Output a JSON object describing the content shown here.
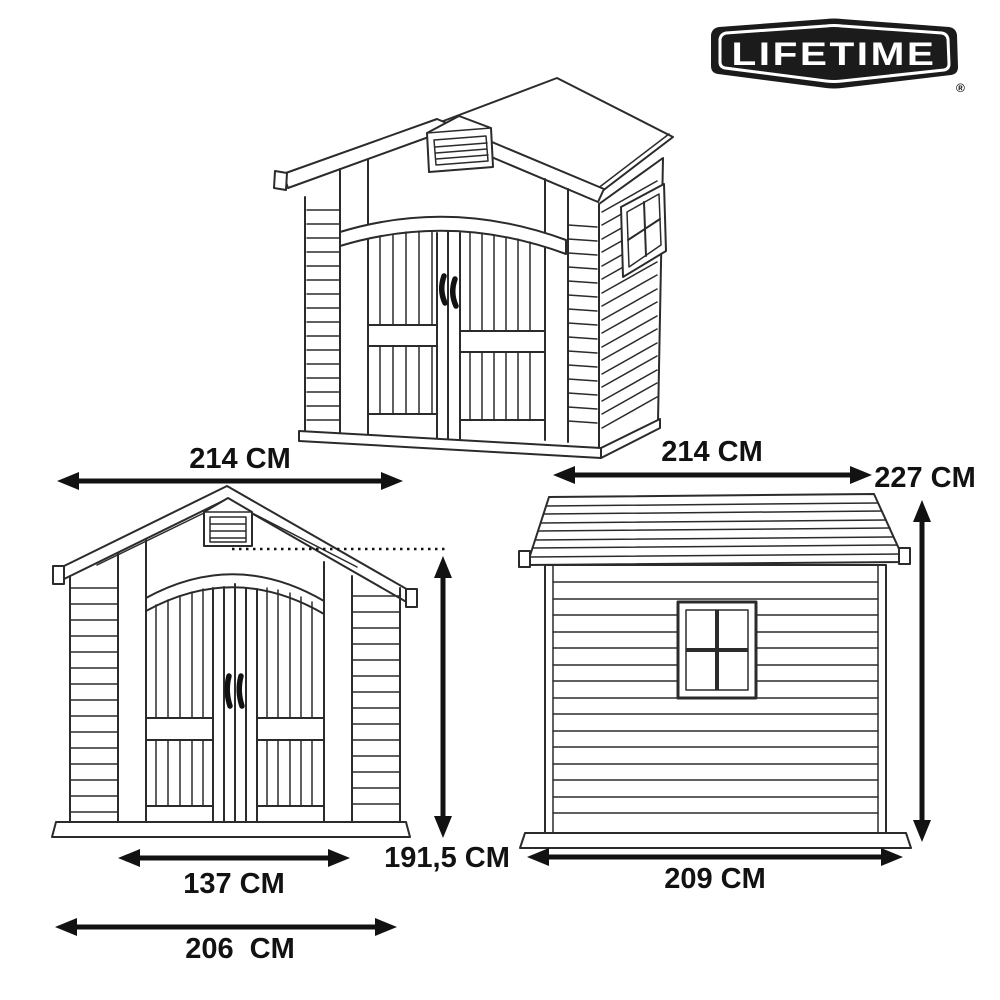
{
  "colors": {
    "background": "#ffffff",
    "linework": "#2b2b2b",
    "annotation": "#121212",
    "logo_bg": "#1b1b1b",
    "logo_text": "#ffffff"
  },
  "logo": {
    "brand": "LIFETIME",
    "registered": "®"
  },
  "dimensions": {
    "front_width": {
      "label": "214 CM",
      "value_cm": 214,
      "orientation": "horizontal",
      "view": "front"
    },
    "side_width": {
      "label": "214 CM",
      "value_cm": 214,
      "orientation": "horizontal",
      "view": "side"
    },
    "total_height": {
      "label": "227 CM",
      "value_cm": 227,
      "orientation": "vertical",
      "view": "side"
    },
    "eave_height": {
      "label": "191,5 CM",
      "value_cm": 191.5,
      "orientation": "vertical",
      "view": "front"
    },
    "door_opening_width": {
      "label": "137 CM",
      "value_cm": 137,
      "orientation": "horizontal",
      "view": "front"
    },
    "front_base_width": {
      "label": "206  CM",
      "value_cm": 206,
      "orientation": "horizontal",
      "view": "front"
    },
    "side_base_width": {
      "label": "209 CM",
      "value_cm": 209,
      "orientation": "horizontal",
      "view": "side"
    }
  }
}
